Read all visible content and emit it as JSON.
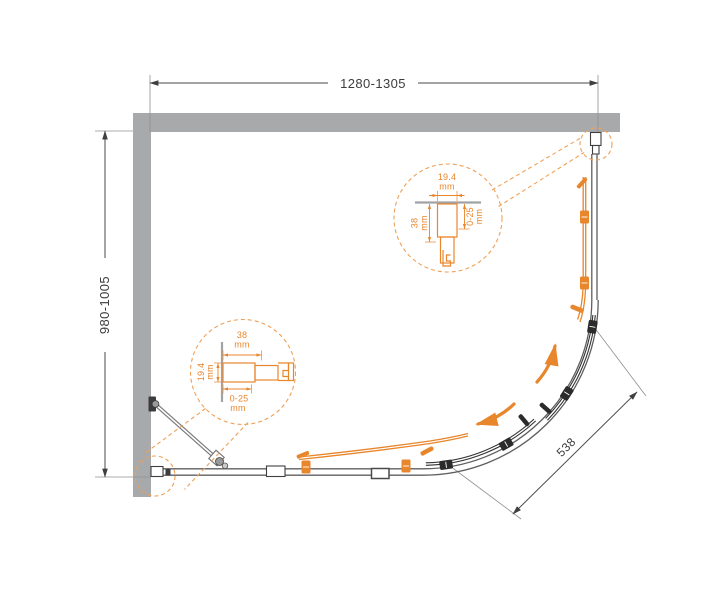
{
  "drawing": {
    "type": "shower-enclosure-floor-plan",
    "dimensions": {
      "top_width": "1280-1305",
      "left_depth": "980-1005",
      "entry_diagonal": "538"
    },
    "detail_left": {
      "profile_depth": {
        "value": "38",
        "unit": "mm"
      },
      "profile_width": {
        "value": "19.4",
        "unit": "mm"
      },
      "adjustment_range": {
        "value": "0-25",
        "unit": "mm"
      }
    },
    "detail_right": {
      "profile_width": {
        "value": "19.4",
        "unit": "mm"
      },
      "profile_depth": {
        "value": "38",
        "unit": "mm"
      },
      "adjustment_range": {
        "value": "0-25",
        "unit": "mm"
      }
    },
    "colors": {
      "accent": "#E8862C",
      "accent_light": "#EFA057",
      "wall_gray": "#A7A9AB",
      "text_gray": "#3D3D3D"
    }
  }
}
